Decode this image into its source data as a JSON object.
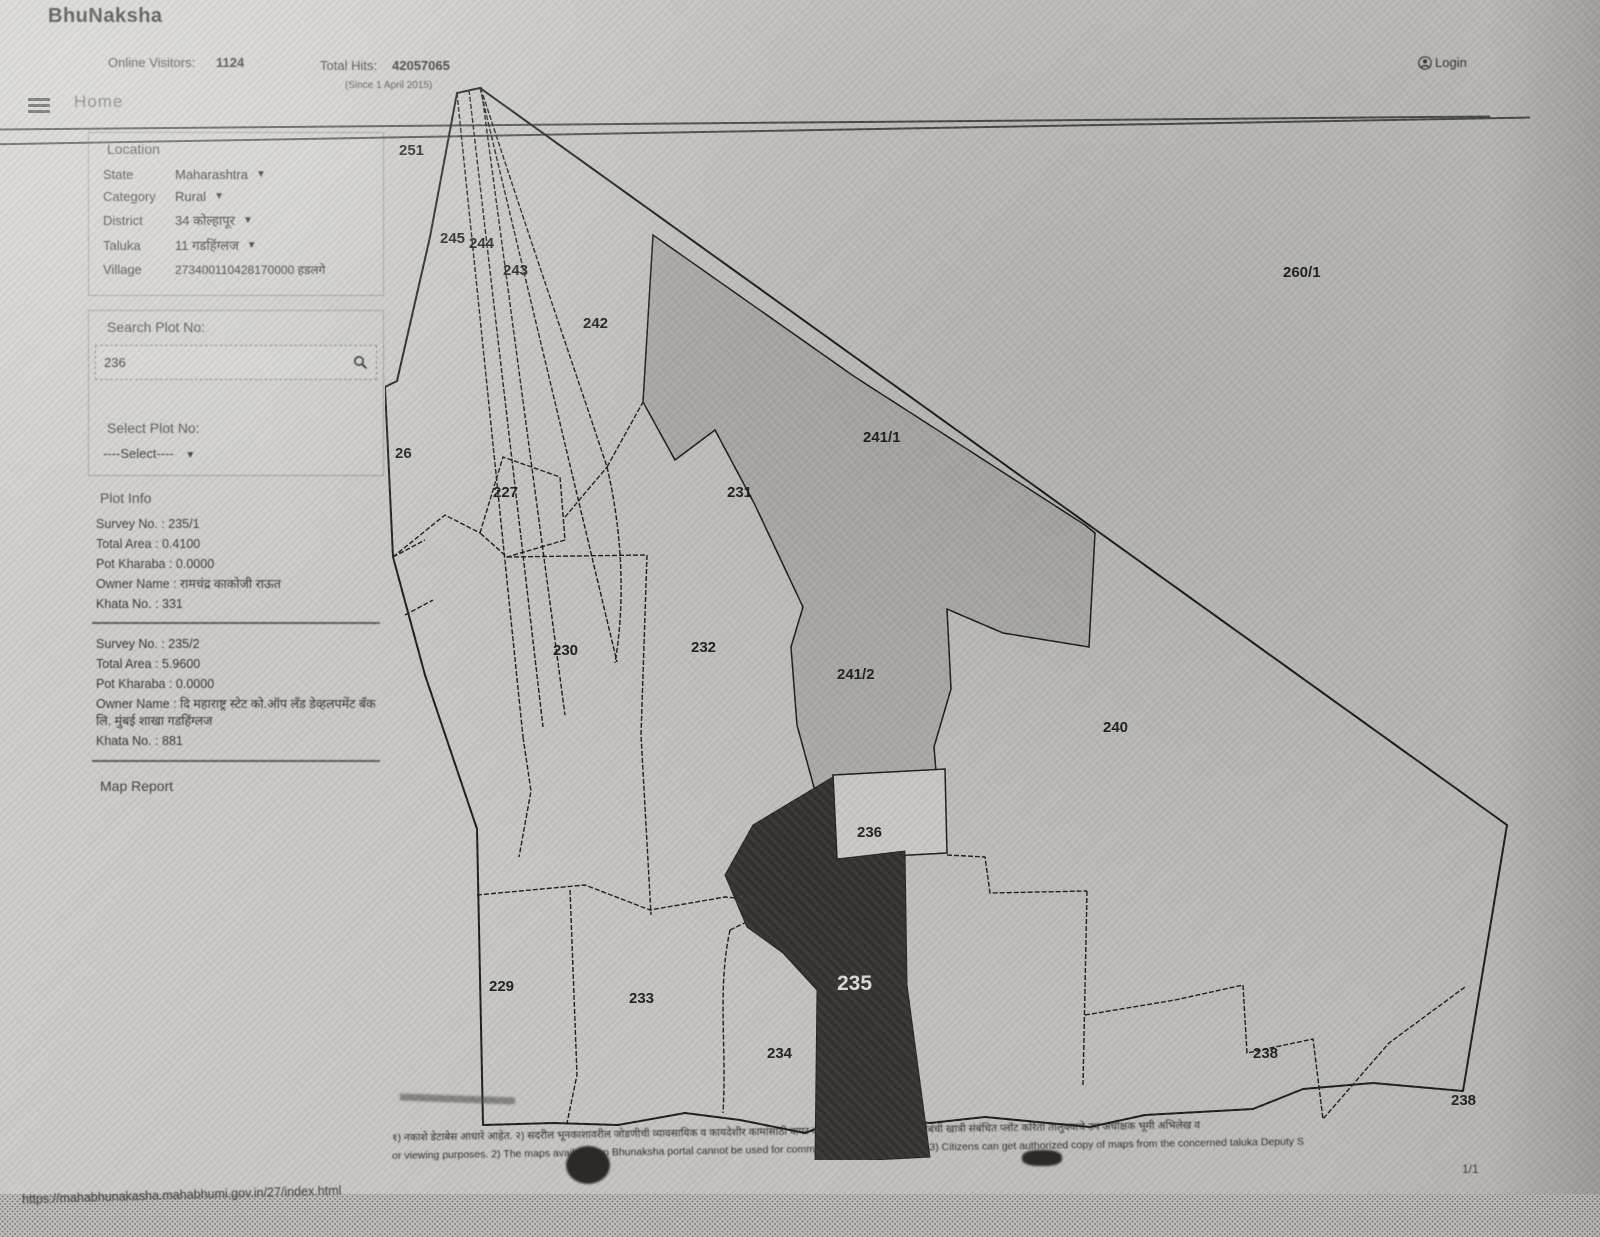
{
  "app": {
    "title": "BhuNaksha"
  },
  "header": {
    "online_visitors_label": "Online Visitors:",
    "online_visitors": "1124",
    "total_hits_label": "Total Hits:",
    "total_hits": "42057065",
    "since": "(Since 1 April 2015)",
    "login_label": "Login"
  },
  "nav": {
    "home": "Home"
  },
  "sidebar": {
    "location": {
      "title": "Location",
      "rows": [
        {
          "label": "State",
          "value": "Maharashtra",
          "dropdown": true
        },
        {
          "label": "Category",
          "value": "Rural",
          "dropdown": true
        },
        {
          "label": "District",
          "value": "34 कोल्हापूर",
          "dropdown": true
        },
        {
          "label": "Taluka",
          "value": "11 गडहिंग्लज",
          "dropdown": true
        },
        {
          "label": "Village",
          "value": "273400110428170000 हडलगे",
          "dropdown": false
        }
      ]
    },
    "search": {
      "label": "Search Plot No:",
      "value": "236"
    },
    "select": {
      "label": "Select Plot No:",
      "value": "----Select----"
    },
    "plot_info": {
      "title": "Plot Info",
      "blocks": [
        {
          "survey_no": "Survey No. : 235/1",
          "total_area": "Total Area : 0.4100",
          "pot_kharaba": "Pot Kharaba : 0.0000",
          "owner": "Owner Name : रामचंद्र काकोजी राऊत",
          "khata": "Khata No. : 331"
        },
        {
          "survey_no": "Survey No. : 235/2",
          "total_area": "Total Area : 5.9600",
          "pot_kharaba": "Pot Kharaba : 0.0000",
          "owner": "Owner Name : दि महाराष्ट्र स्टेट को.ऑप लँड डेव्हलपमेंट बँक लि. मुंबई शाखा गडहिंग्लज",
          "khata": "Khata No. : 881"
        }
      ]
    },
    "map_report": "Map Report"
  },
  "map": {
    "selected_plot": "235",
    "plots": [
      {
        "label": "251",
        "x": 14,
        "y": 70
      },
      {
        "label": "245",
        "x": 55,
        "y": 158
      },
      {
        "label": "244",
        "x": 84,
        "y": 163
      },
      {
        "label": "243",
        "x": 118,
        "y": 190
      },
      {
        "label": "242",
        "x": 198,
        "y": 243
      },
      {
        "label": "260/1",
        "x": 898,
        "y": 192
      },
      {
        "label": "26",
        "x": 10,
        "y": 373
      },
      {
        "label": "227",
        "x": 108,
        "y": 412
      },
      {
        "label": "231",
        "x": 342,
        "y": 412
      },
      {
        "label": "241/1",
        "x": 478,
        "y": 357
      },
      {
        "label": "230",
        "x": 168,
        "y": 570
      },
      {
        "label": "232",
        "x": 306,
        "y": 567
      },
      {
        "label": "241/2",
        "x": 452,
        "y": 594
      },
      {
        "label": "240",
        "x": 718,
        "y": 647
      },
      {
        "label": "236",
        "x": 472,
        "y": 752
      },
      {
        "label": "235",
        "x": 452,
        "y": 905,
        "variant": "selected"
      },
      {
        "label": "229",
        "x": 104,
        "y": 906
      },
      {
        "label": "233",
        "x": 244,
        "y": 918
      },
      {
        "label": "234",
        "x": 382,
        "y": 973
      },
      {
        "label": "238",
        "x": 868,
        "y": 973
      },
      {
        "label": "238",
        "x": 1066,
        "y": 1020
      }
    ]
  },
  "footer": {
    "disclaimer_marathi": "१) नकाशे डेटाबेस आधारे आहेत. २) सदरील भूनकाशावरील जोडणीची व्यावसायिक व कायदेशीर कामांसाठी वापर करता येणार नाही. ३) मालकीसंबंधी खात्री संबंधित प्लॉट करिता तालुक्याचे उप अधीक्षक भूमी अभिलेख व",
    "disclaimer_english": "or viewing purposes. 2) The maps available on Bhunaksha portal cannot be used for commercial or legal purposes. 3) Citizens can get authorized copy of maps from the concerned taluka Deputy S",
    "url": "https://mahabhunakasha.mahabhumi.gov.in/27/index.html",
    "page_indicator": "1/1"
  }
}
